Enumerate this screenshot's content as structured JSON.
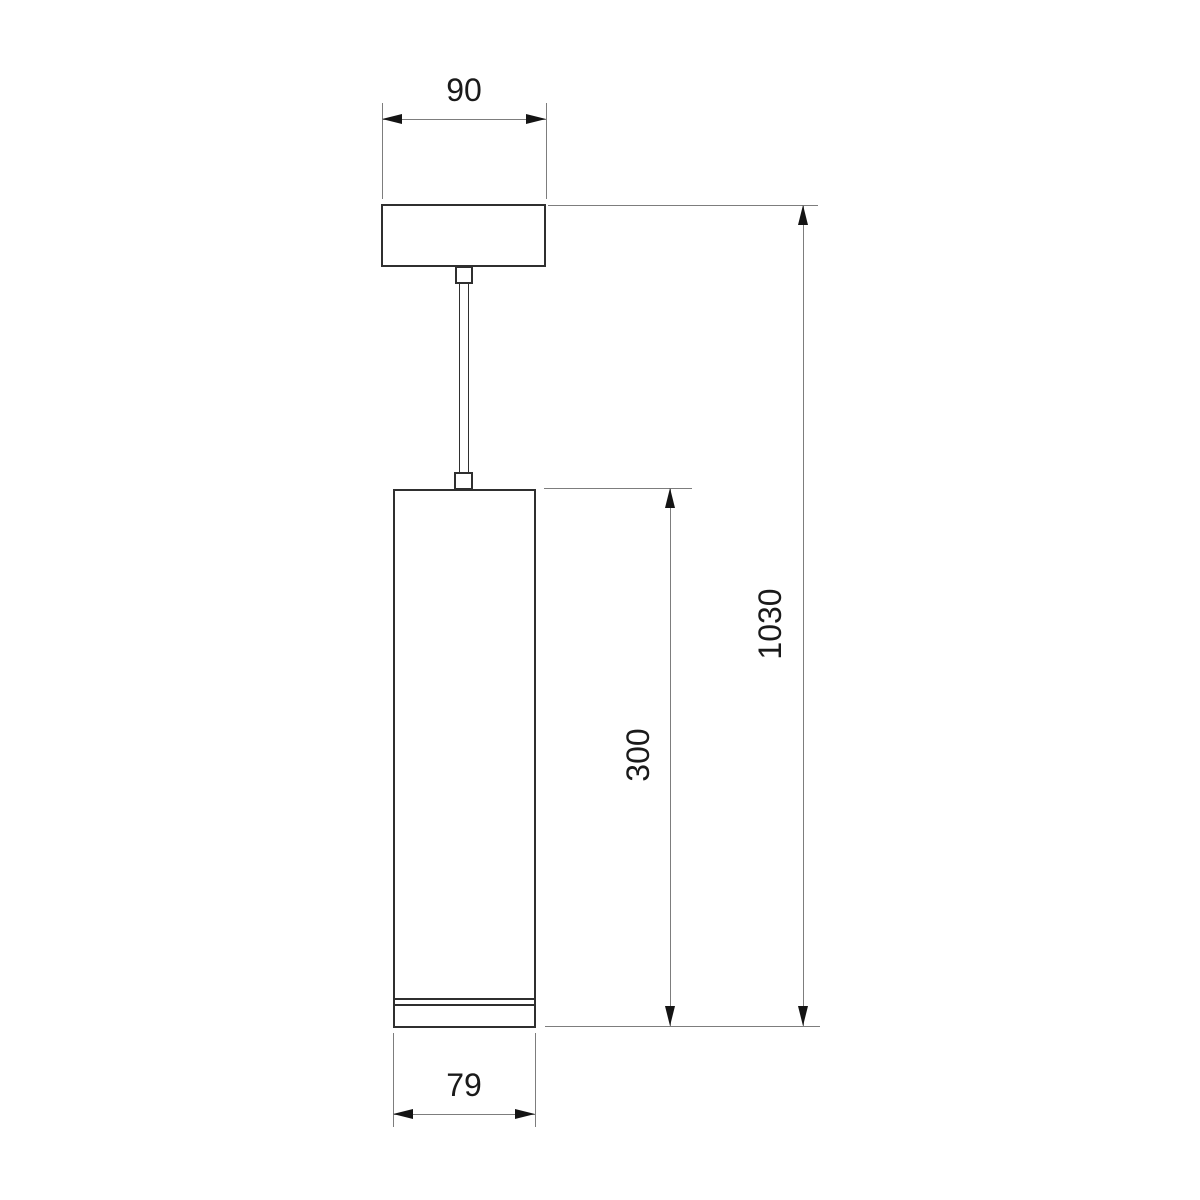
{
  "drawing": {
    "kind": "pendant-light-dimension-drawing",
    "colors": {
      "background": "#ffffff",
      "object_line": "#2f2f2f",
      "dimension_line": "#7d7d7d",
      "arrowhead": "#141414",
      "label_text": "#1a1a1a"
    }
  },
  "dims": {
    "canopy_width": "90",
    "overall_height": "1030",
    "body_height": "300",
    "body_width": "79"
  }
}
